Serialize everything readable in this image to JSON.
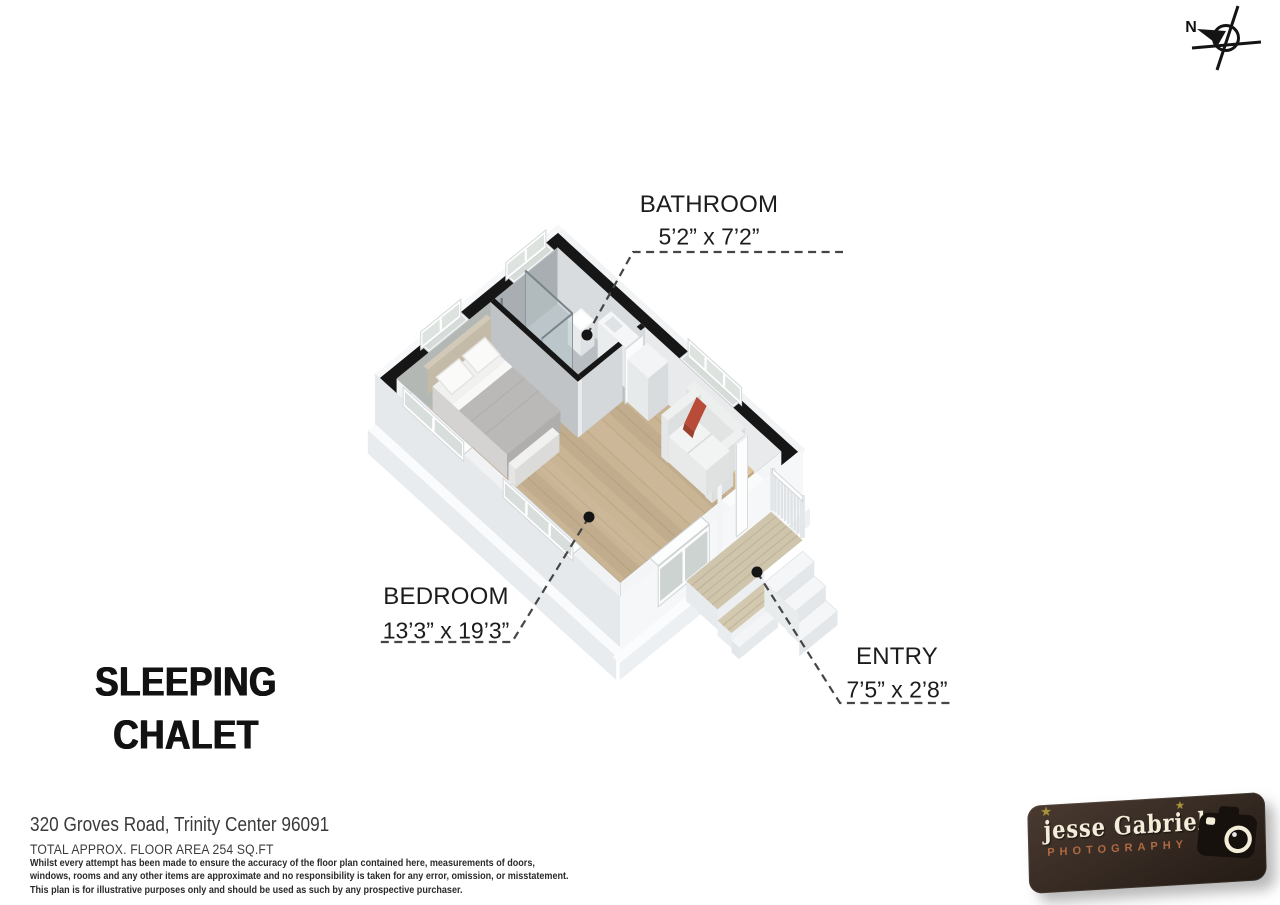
{
  "compass": {
    "label": "N"
  },
  "rooms": [
    {
      "name": "BATHROOM",
      "dims": "5’2” x 7’2”"
    },
    {
      "name": "BEDROOM",
      "dims": "13’3” x 19’3”"
    },
    {
      "name": "ENTRY",
      "dims": "7’5” x 2’8”"
    }
  ],
  "title": {
    "line1": "SLEEPING",
    "line2": "CHALET"
  },
  "footer": {
    "address": "320 Groves Road, Trinity Center 96091",
    "floor_area": "TOTAL APPROX. FLOOR AREA 254 SQ.FT",
    "disclaimer": [
      "Whilst every attempt has been made to ensure the accuracy of the floor plan contained here, measurements of doors,",
      "windows, rooms and any other items are approximate and no responsibility is taken for any error, omission, or misstatement.",
      "This plan is for illustrative purposes only and should be used as such by any prospective purchaser."
    ]
  },
  "logo": {
    "name": "jesse Gabriel",
    "subtitle": "PHOTOGRAPHY"
  },
  "icons": {
    "compass": "compass-icon",
    "camera": "camera-icon",
    "star": "star-icon"
  },
  "colors": {
    "wall": "#161616",
    "wood_floor": "#c9b493",
    "wood_line": "#b29d78",
    "deck_wood": "#cfc5ac",
    "deck_line": "#bdb197",
    "bathroom_floor": "#b9bec3",
    "pillow_red": "#b84c38",
    "leader": "#454545",
    "logo_bg": "#32271f",
    "logo_name": "#f4edda",
    "logo_subtitle": "#b06a42"
  }
}
